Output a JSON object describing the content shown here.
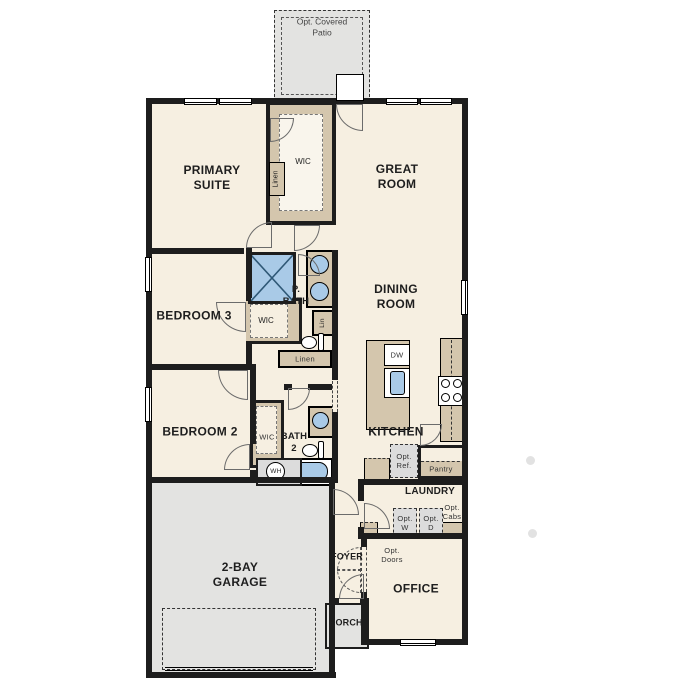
{
  "plan": {
    "patio": "Opt. Covered\nPatio",
    "primary_suite": "PRIMARY\nSUITE",
    "primary_wic": "WIC",
    "primary_linen": "Linen",
    "great_room": "GREAT\nROOM",
    "bedroom3": "BEDROOM 3",
    "bedroom3_wic": "WIC",
    "p_bath": "P.\nBATH",
    "p_bath_lin": "Lin",
    "hall_linen": "Linen",
    "dining_room": "DINING\nROOM",
    "island_dw": "DW",
    "kitchen": "KITCHEN",
    "opt_ref": "Opt.\nRef.",
    "pantry": "Pantry",
    "laundry": "LAUNDRY",
    "opt_washer": "Opt.\nW",
    "opt_dryer": "Opt.\nD",
    "opt_cabs": "Opt.\nCabs",
    "bedroom2": "BEDROOM 2",
    "bedroom2_wic": "WIC",
    "bath2": "BATH\n2",
    "water_heater": "WH",
    "garage": "2-BAY\nGARAGE",
    "foyer": "FOYER",
    "opt_doors": "Opt.\nDoors",
    "office": "OFFICE",
    "porch": "PORCH"
  },
  "colors": {
    "wall": "#1d1d1d",
    "floor": "#f6efe1",
    "concrete": "#e3e3e1",
    "casework_tan": "#d4c6ad",
    "fixture_blue": "#a9cae7",
    "optional_gray": "#dcdcdc"
  }
}
